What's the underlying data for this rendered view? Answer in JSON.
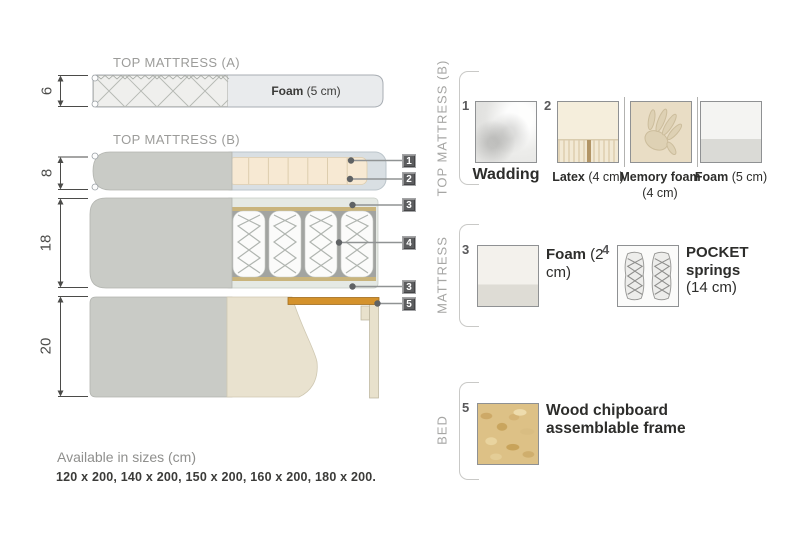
{
  "diagram": {
    "top_a": {
      "dim": "6",
      "title": "TOP MATTRESS (A)",
      "foam_bold": "Foam",
      "foam_rest": " (5 cm)"
    },
    "top_b": {
      "dim": "8",
      "title": "TOP MATTRESS (B)"
    },
    "mattress": {
      "dim": "18"
    },
    "bed": {
      "dim": "20"
    },
    "callouts": [
      {
        "num": "1"
      },
      {
        "num": "2"
      },
      {
        "num": "3"
      },
      {
        "num": "4"
      },
      {
        "num": "3"
      },
      {
        "num": "5"
      }
    ]
  },
  "legend": {
    "group_top": "TOP MATTRESS (B)",
    "group_mattress": "MATTRESS",
    "group_bed": "BED",
    "wadding": {
      "num": "1",
      "bold": "Wadding",
      "rest": ""
    },
    "latex": {
      "num": "2",
      "bold": "Latex",
      "rest": " (4 cm)"
    },
    "memory_foam": {
      "bold": "Memory foam",
      "rest": " (4 cm)"
    },
    "foam_5": {
      "bold": "Foam",
      "rest": " (5 cm)"
    },
    "foam_2": {
      "num": "3",
      "bold": "Foam",
      "rest": " (2 cm)"
    },
    "pocket_springs": {
      "num": "4",
      "bold": "POCKET springs",
      "rest": " (14 cm)"
    },
    "wood": {
      "num": "5",
      "bold": "Wood chipboard assemblable frame",
      "rest": ""
    }
  },
  "footer": {
    "title": "Available in sizes (cm)",
    "sizes": "120 x 200, 140 x 200, 150 x 200, 160 x 200, 180 x 200."
  },
  "colors": {
    "fabric_gray": "#c9cbc6",
    "foam_cream": "#f6e8d2",
    "wadding_blue": "#d9dfe3",
    "wood_slat": "#d4922c",
    "chip_bg": "#5c5d5f"
  }
}
